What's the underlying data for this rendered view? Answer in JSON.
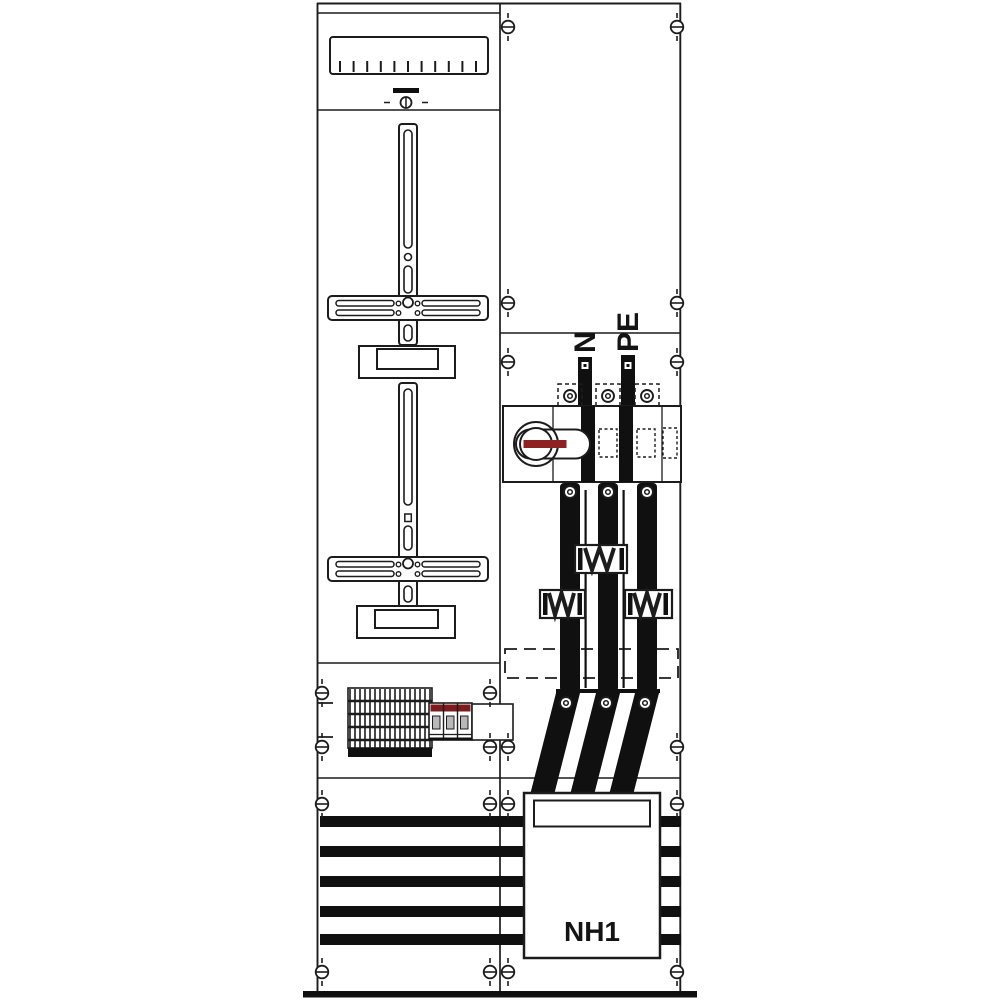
{
  "diagram": {
    "labels": {
      "neutral": "N",
      "protective_earth": "PE",
      "fuse_switch_size": "NH1"
    }
  },
  "colors": {
    "line": "#1c1c1c",
    "busbar_black": "#101010",
    "switch_handle_red": "#8e2121",
    "breaker_red": "#7c1b1b",
    "toggle_gray": "#b8b8b8",
    "background": "#ffffff"
  }
}
